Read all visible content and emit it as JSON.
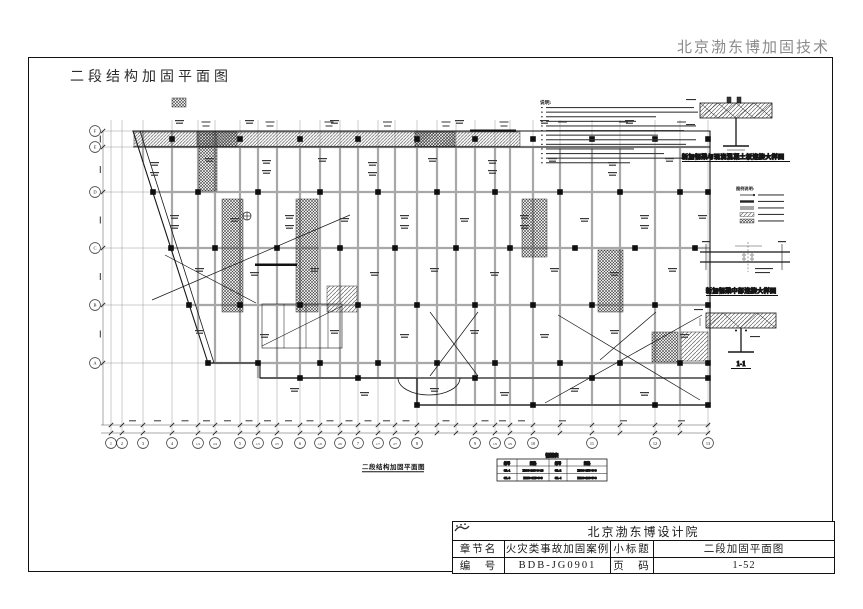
{
  "header": {
    "company": "北京渤东博加固技术"
  },
  "sheet": {
    "title": "二段结构加固平面图"
  },
  "plan": {
    "caption": "二段结构加固平面图",
    "notes_heading": "说明:",
    "legend_heading": "图例说明:",
    "detail1_caption": "新加钢梁与现浇混凝土板连接大样图",
    "detail2_caption": "新加钢梁中部连接大样图",
    "section_caption": "1-1",
    "axis_letters": [
      "F",
      "E",
      "D",
      "C",
      "B",
      "A"
    ],
    "axis_numbers": [
      "1",
      "2",
      "3",
      "4",
      "1/4",
      "2/4",
      "5",
      "1/5",
      "2/5",
      "6",
      "1/6",
      "2/6",
      "7",
      "1/7",
      "2/7",
      "8",
      "9",
      "1/9",
      "2/9",
      "10",
      "11",
      "12",
      "13"
    ],
    "steel_table": {
      "title": "钢梁表",
      "headers": [
        "编号",
        "规格",
        "编号",
        "规格"
      ],
      "rows": [
        [
          "GL-1",
          "H400×200×8×13",
          "GL-2",
          "H300×150×6×9"
        ],
        [
          "GL-3",
          "H250×125×6×9",
          "GL-4",
          "H200×100×5×8"
        ]
      ]
    }
  },
  "title_block": {
    "institute": "北京渤东博设计院",
    "chapter_label": "章节名",
    "chapter_value": "火灾类事故加固案例",
    "subtitle_label": "小标题",
    "subtitle_value": "二段加固平面图",
    "number_label": "编　号",
    "number_value": "BDB-JG0901",
    "page_label": "页　码",
    "page_value": "1-52"
  },
  "colors": {
    "line": "#1a1a1a",
    "beam_gray": "#a8a8a8",
    "header_gray": "#8a8a8a"
  }
}
